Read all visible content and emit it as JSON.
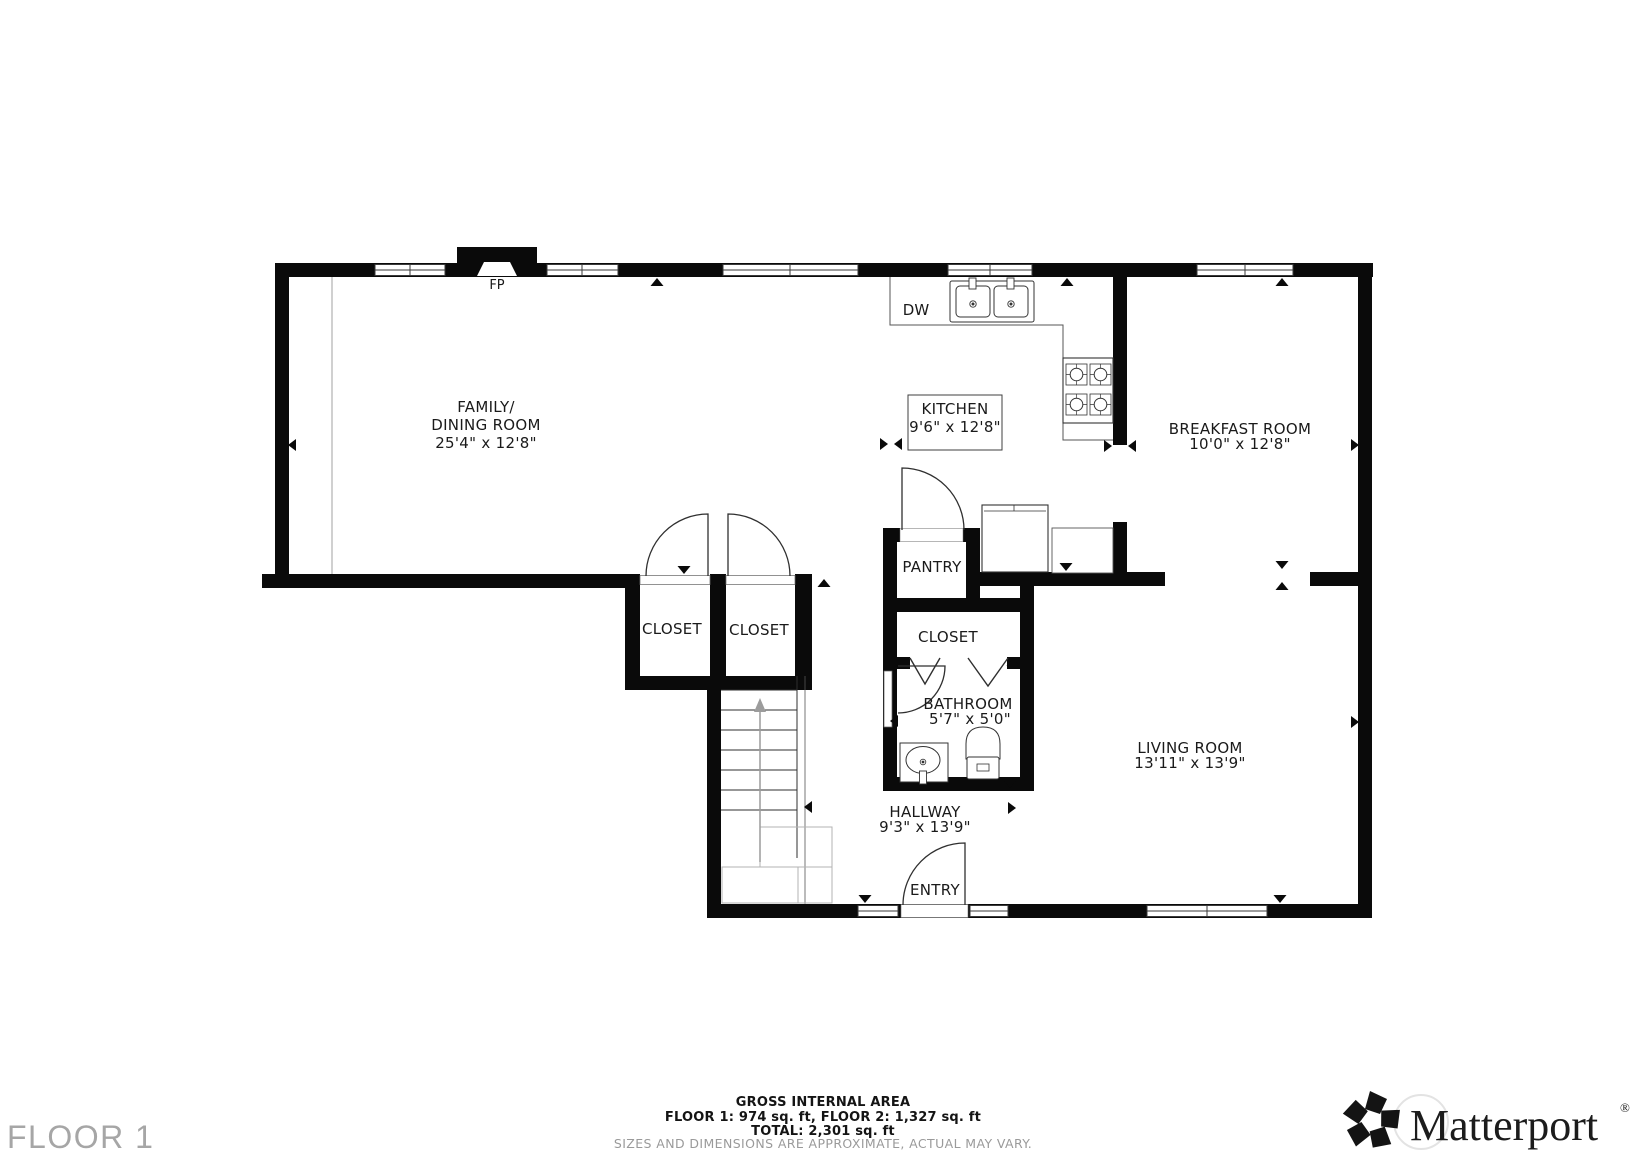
{
  "plan": {
    "rooms": {
      "family": {
        "line1": "FAMILY/",
        "line2": "DINING ROOM",
        "dims": "25'4\" x 12'8\""
      },
      "kitchen": {
        "name": "KITCHEN",
        "dims": "9'6\" x 12'8\""
      },
      "breakfast": {
        "name": "BREAKFAST ROOM",
        "dims": "10'0\" x 12'8\""
      },
      "living": {
        "name": "LIVING ROOM",
        "dims": "13'11\" x 13'9\""
      },
      "bathroom": {
        "name": "BATHROOM",
        "dims": "5'7\" x 5'0\""
      },
      "hallway": {
        "name": "HALLWAY",
        "dims": "9'3\" x 13'9\""
      },
      "pantry": {
        "name": "PANTRY"
      },
      "closet_left": {
        "name": "CLOSET"
      },
      "closet_center": {
        "name": "CLOSET"
      },
      "closet_bath": {
        "name": "CLOSET"
      },
      "entry": {
        "name": "ENTRY"
      }
    },
    "fixtures": {
      "fireplace": "FP",
      "dishwasher": "DW"
    }
  },
  "footer": {
    "area_title": "GROSS INTERNAL AREA",
    "area_floors": "FLOOR 1: 974 sq. ft, FLOOR 2: 1,327 sq. ft",
    "area_total": "TOTAL: 2,301 sq. ft",
    "disclaimer": "SIZES AND DIMENSIONS ARE APPROXIMATE, ACTUAL MAY VARY.",
    "floor_label": "FLOOR 1"
  },
  "branding": {
    "name": "Matterport",
    "registered": "®"
  },
  "colors": {
    "wall": "#0a0a0a",
    "line": "#3a3a3a",
    "stair_gray": "#b3b3b3",
    "muted_text": "#9a9a9a"
  }
}
